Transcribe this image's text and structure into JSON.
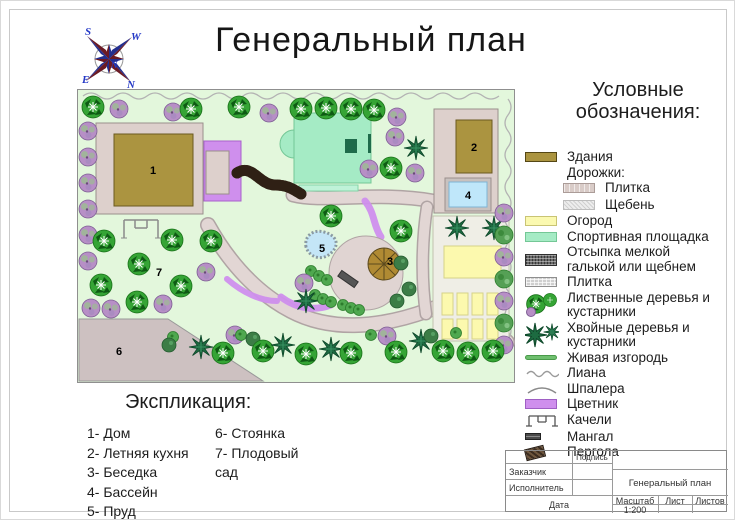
{
  "title": "Генеральный план",
  "compass": {
    "s": "S",
    "w": "W",
    "e": "E",
    "n": "N",
    "center": "N"
  },
  "legend": {
    "heading": "Условные обозначения:",
    "items": [
      "Здания",
      "Дорожки:",
      "Плитка",
      "Щебень",
      "Огород",
      "Спортивная площадка",
      "Отсыпка мелкой галькой или щебнем",
      "Плитка",
      "Лиственные деревья и кустарники",
      "Хвойные деревья и кустарники",
      "Живая изгородь",
      "Лиана",
      "Шпалера",
      "Цветник",
      "Качели",
      "Мангал",
      "Пергола"
    ]
  },
  "explication": {
    "heading": "Экспликация:",
    "col1": [
      "1- Дом",
      "2- Летняя кухня",
      "3- Беседка",
      "4- Бассейн",
      "5- Пруд"
    ],
    "col2": [
      "6- Стоянка",
      "7- Плодовый сад"
    ]
  },
  "plan": {
    "labels": {
      "house": "1",
      "summer_kitchen": "2",
      "gazebo": "3",
      "pool": "4",
      "pond": "5",
      "parking": "6",
      "orchard": "7"
    }
  },
  "title_block": {
    "signature": "Подпись",
    "customer": "Заказчик",
    "executor": "Исполнитель",
    "drawing_title": "Генеральный план",
    "date": "Дата",
    "scale_label": "Масштаб",
    "scale_value": "1:200",
    "sheet_label": "Лист",
    "sheets_label": "Листов"
  },
  "colors": {
    "plan_background": "#e3f7dc",
    "building": "#ab9440",
    "path": "#e2d6d4",
    "pebble_path": "#4d3827",
    "flowerbed": "#cf8fed",
    "sport_ground": "#a5ebc5",
    "garden_bed": "#fcf9ae",
    "pool": "#bfe7fa",
    "pond": "#c4e6f7",
    "parking": "#cdc1c1",
    "deciduous": "#35a435",
    "conifer": "#1d6b41",
    "bush": "#b78fc6",
    "hedge": "#6fbf6f"
  }
}
